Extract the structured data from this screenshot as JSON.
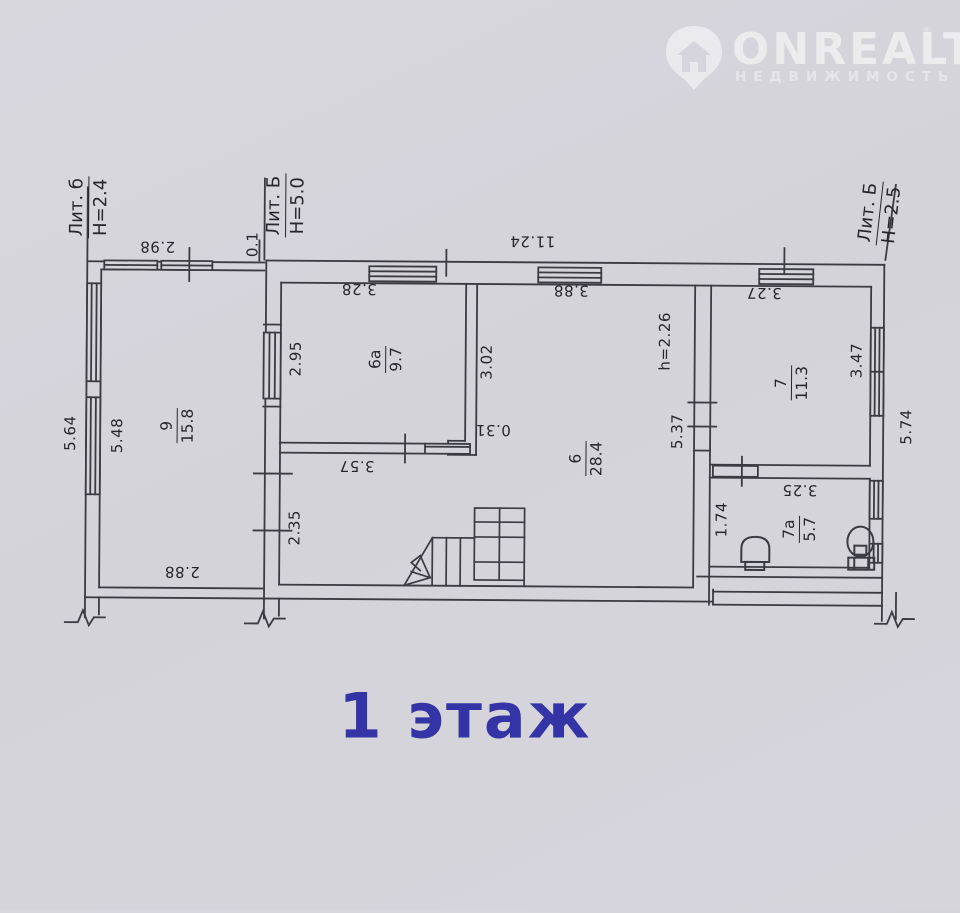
{
  "watermark": {
    "brand": "ONREALT",
    "subtitle": "НЕДВИЖИМОСТЬ",
    "reg": "®"
  },
  "floor_label": "1 этаж",
  "accent_color": "#3434a6",
  "building_labels": [
    {
      "id": "lit-b-annex",
      "line1": "Лит. б",
      "line2": "Н=2.4",
      "x": 87,
      "y": 210,
      "rot": -90
    },
    {
      "id": "lit-B-main",
      "line1": "Лит. Б",
      "line2": "Н=5.0",
      "x": 284,
      "y": 207,
      "rot": -90
    },
    {
      "id": "lit-B-right",
      "line1": "Лит. Б",
      "line2": "Н=2.5",
      "x": 878,
      "y": 211,
      "rot": -84
    }
  ],
  "rooms": [
    {
      "id": "9",
      "number": "9",
      "area": "15.8",
      "x": 177,
      "y": 428,
      "rot": -90
    },
    {
      "id": "6a",
      "number": "6а",
      "area": "9.7",
      "x": 385,
      "y": 360,
      "rot": -90
    },
    {
      "id": "6",
      "number": "6",
      "area": "28.4",
      "x": 586,
      "y": 458,
      "rot": -90
    },
    {
      "id": "7",
      "number": "7",
      "area": "11.3",
      "x": 791,
      "y": 381,
      "rot": -90
    },
    {
      "id": "7a",
      "number": "7а",
      "area": "5.7",
      "x": 800,
      "y": 527,
      "rot": -90
    }
  ],
  "dimensions": [
    {
      "text": "2.98",
      "x": 156,
      "y": 249,
      "rot": 180
    },
    {
      "text": "0.1",
      "x": 251,
      "y": 246,
      "rot": -90
    },
    {
      "text": "11.24",
      "x": 531,
      "y": 241,
      "rot": 180
    },
    {
      "text": "3.28",
      "x": 358,
      "y": 290,
      "rot": 180
    },
    {
      "text": "3.88",
      "x": 570,
      "y": 290,
      "rot": 180
    },
    {
      "text": "3.27",
      "x": 763,
      "y": 291,
      "rot": 180
    },
    {
      "text": "5.64",
      "x": 70,
      "y": 436,
      "rot": -90
    },
    {
      "text": "5.48",
      "x": 117,
      "y": 438,
      "rot": -90
    },
    {
      "text": "2.95",
      "x": 295,
      "y": 360,
      "rot": -90
    },
    {
      "text": "3.02",
      "x": 486,
      "y": 362,
      "rot": -90
    },
    {
      "text": "h=2.26",
      "x": 664,
      "y": 340,
      "rot": -90
    },
    {
      "text": "5.37",
      "x": 677,
      "y": 430,
      "rot": -90
    },
    {
      "text": "3.47",
      "x": 856,
      "y": 358,
      "rot": -90
    },
    {
      "text": "5.74",
      "x": 906,
      "y": 424,
      "rot": -90
    },
    {
      "text": "0.31",
      "x": 493,
      "y": 430,
      "rot": 180
    },
    {
      "text": "3.57",
      "x": 357,
      "y": 467,
      "rot": 180
    },
    {
      "text": "2.35",
      "x": 295,
      "y": 529,
      "rot": -90
    },
    {
      "text": "2.88",
      "x": 183,
      "y": 574,
      "rot": 180
    },
    {
      "text": "1.74",
      "x": 722,
      "y": 518,
      "rot": -90
    },
    {
      "text": "3.25",
      "x": 800,
      "y": 488,
      "rot": 180
    }
  ]
}
